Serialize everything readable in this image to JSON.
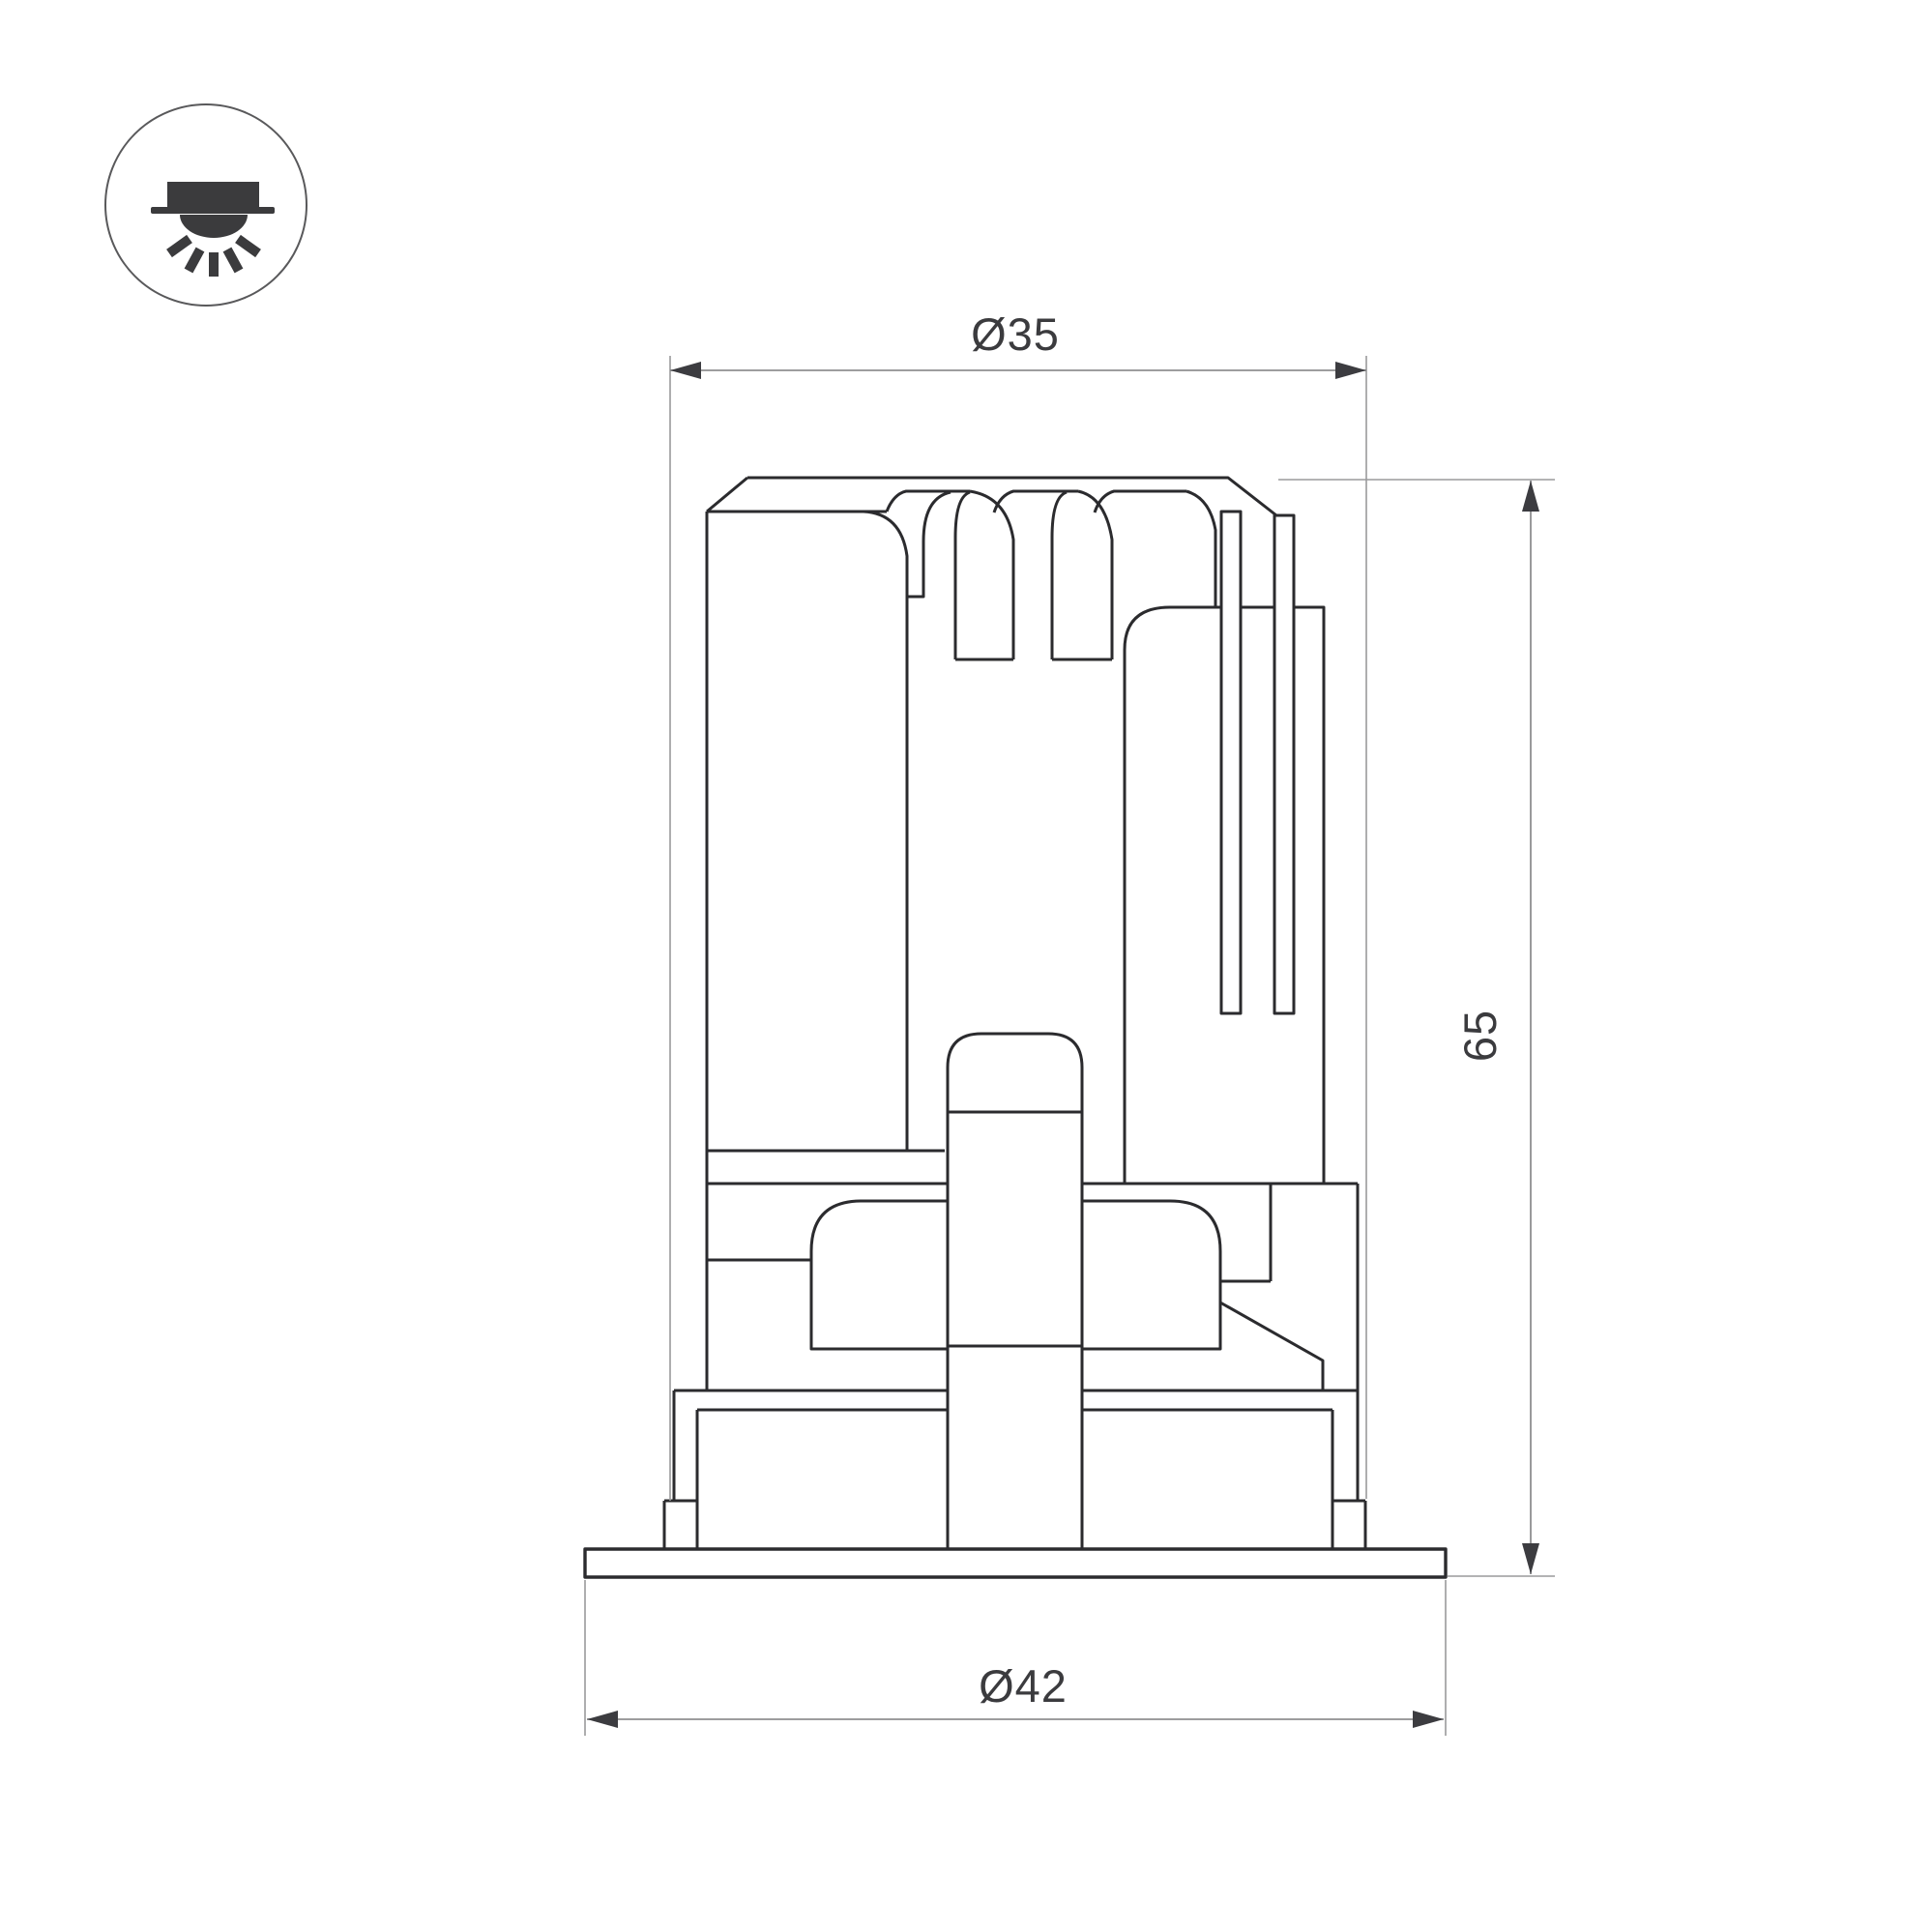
{
  "drawing": {
    "kind": "technical dimension drawing",
    "subject": "recessed downlight luminaire - side section view",
    "icon": {
      "name": "recessed-downlight-icon"
    },
    "dimensions": {
      "top_diameter_label": "Ø35",
      "height_label": "65",
      "flange_diameter_label": "Ø42"
    },
    "colors": {
      "background": "#ffffff",
      "object_line": "#2b2b2e",
      "dimension_line": "#8f8f90",
      "arrow": "#3c3c40",
      "label_text": "#3b3b3e"
    }
  }
}
